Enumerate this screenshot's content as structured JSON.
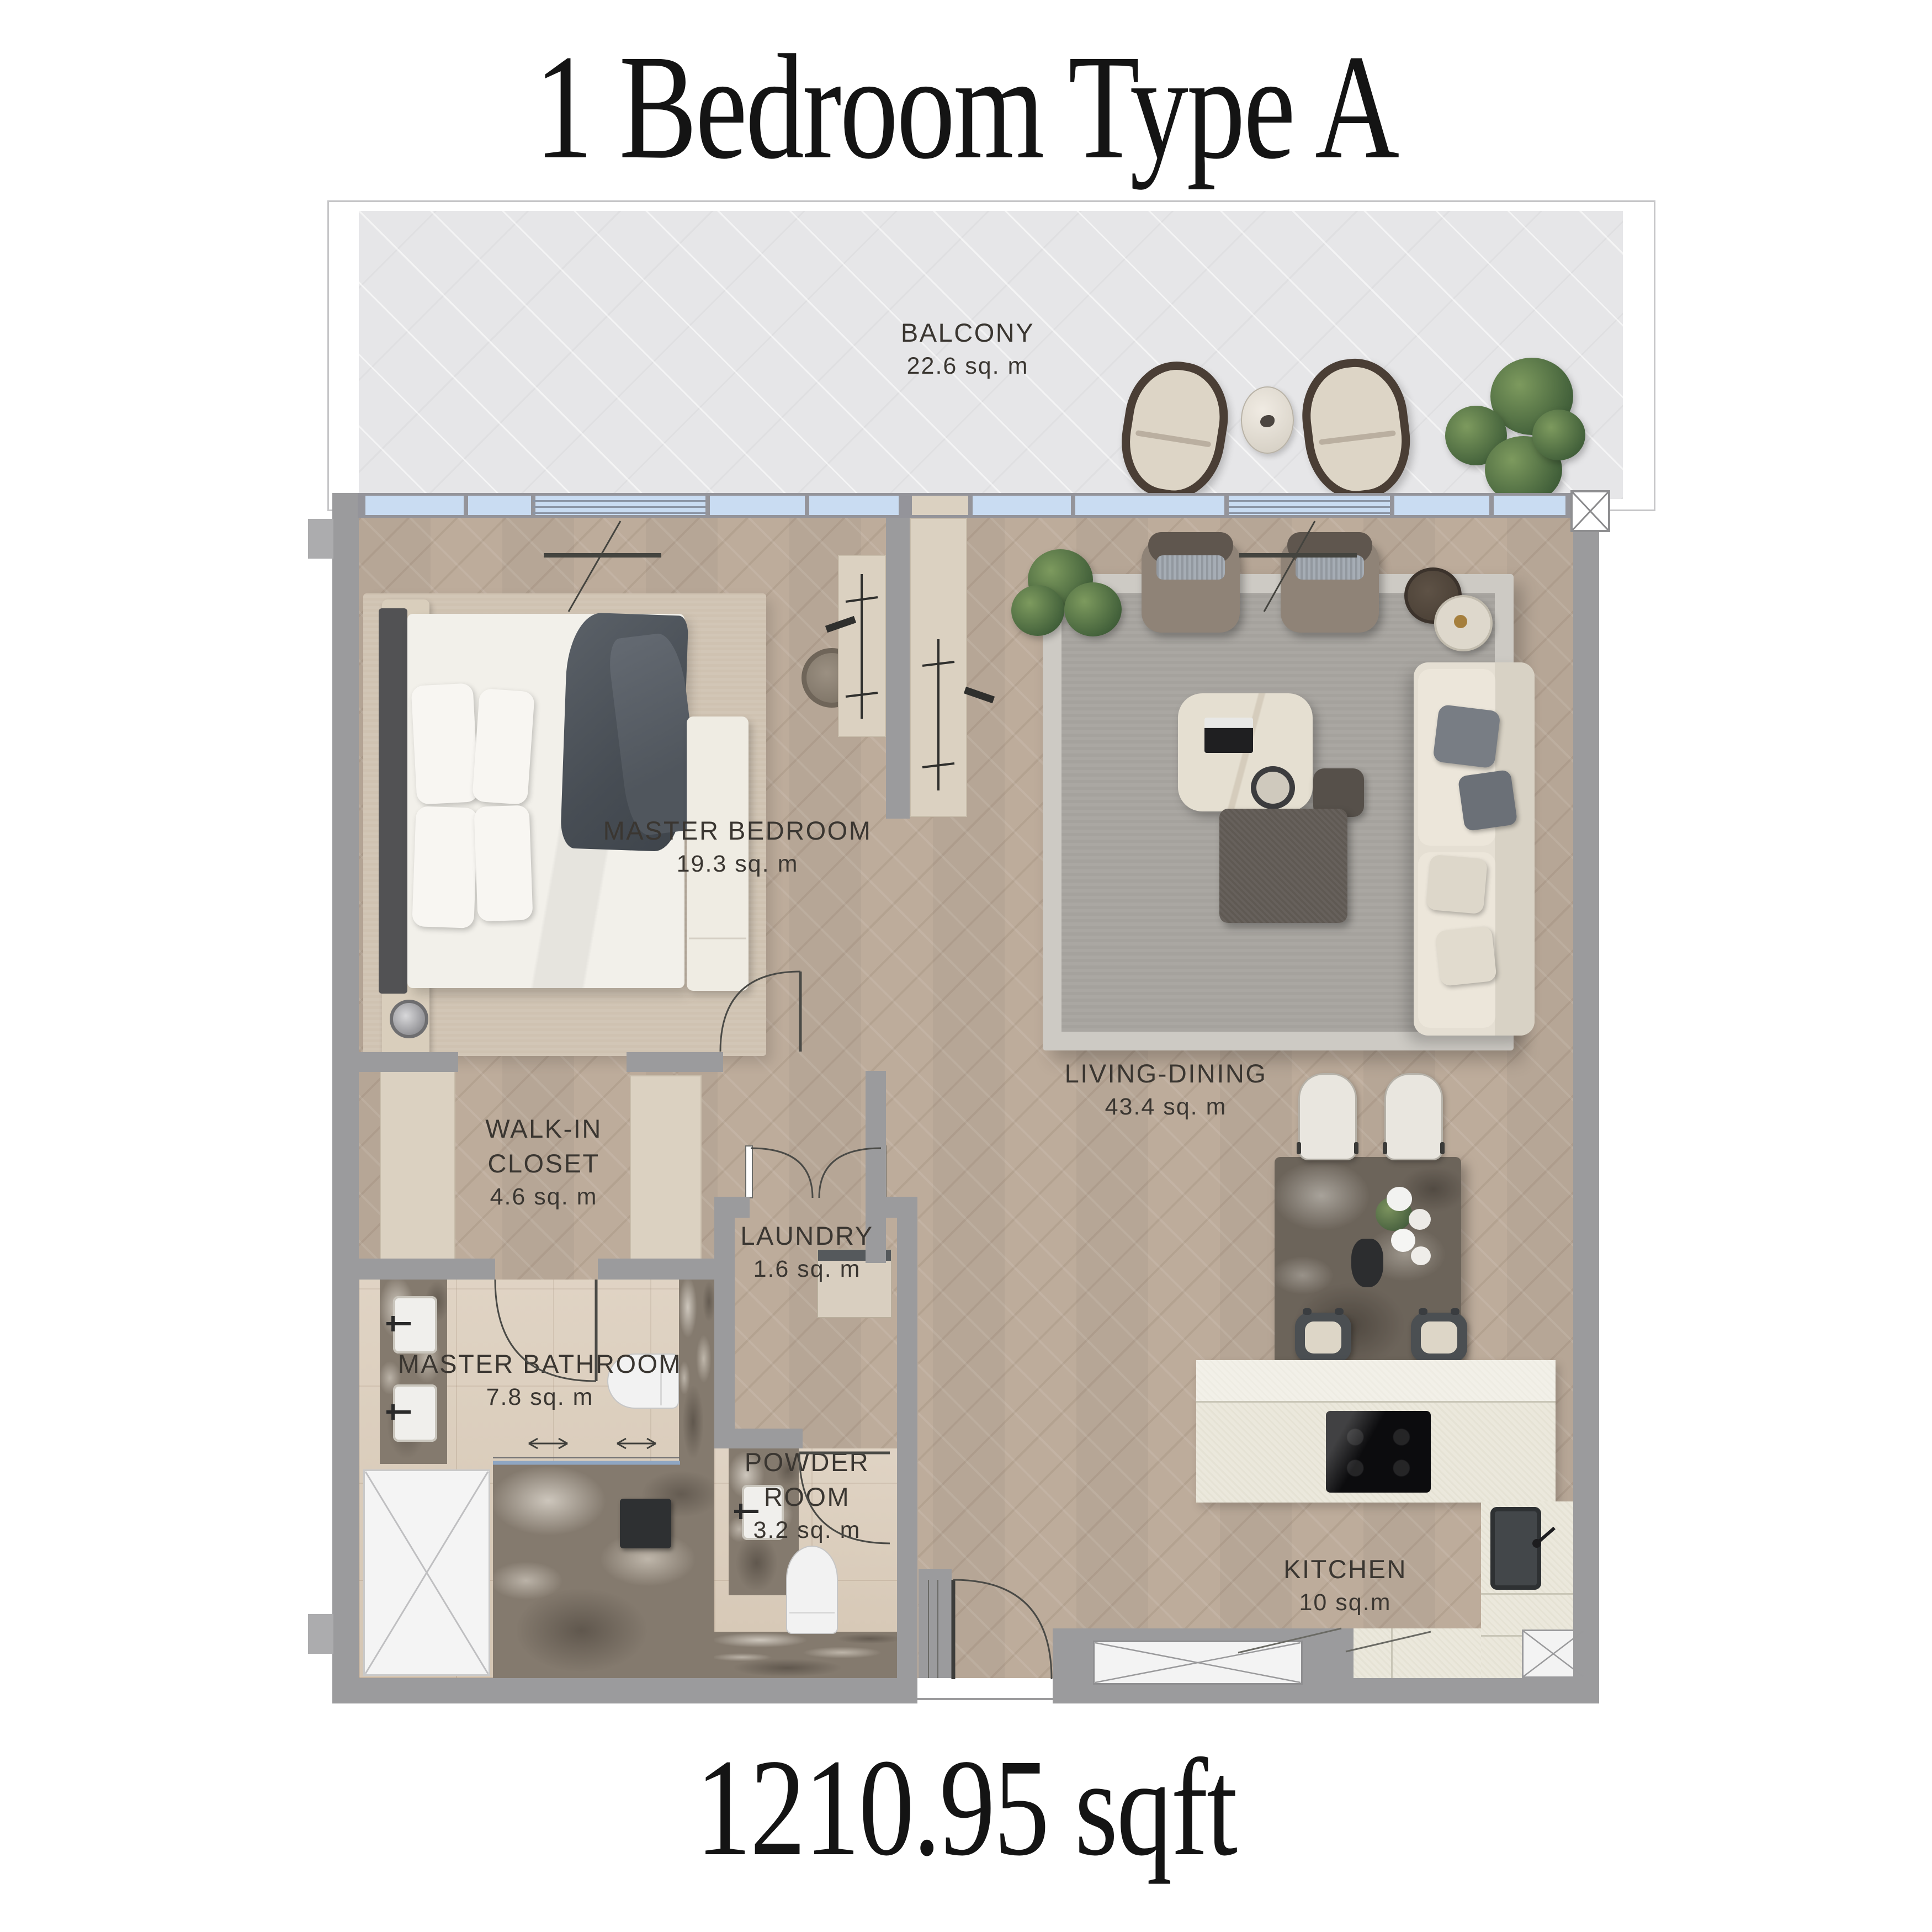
{
  "title": "1 Bedroom Type A",
  "total_area": "1210.95 sqft",
  "rooms": {
    "balcony": {
      "name": "BALCONY",
      "area": "22.6 sq. m"
    },
    "master_bedroom": {
      "name": "MASTER BEDROOM",
      "area": "19.3 sq. m"
    },
    "living_dining": {
      "name": "LIVING-DINING",
      "area": "43.4 sq. m"
    },
    "walk_in_closet": {
      "name1": "WALK-IN",
      "name2": "CLOSET",
      "area": "4.6 sq. m"
    },
    "laundry": {
      "name": "LAUNDRY",
      "area": "1.6 sq. m"
    },
    "master_bathroom": {
      "name": "MASTER BATHROOM",
      "area": "7.8 sq. m"
    },
    "powder_room": {
      "name1": "POWDER",
      "name2": "ROOM",
      "area": "3.2 sq. m"
    },
    "kitchen": {
      "name": "KITCHEN",
      "area": "10 sq.m"
    }
  },
  "colors": {
    "wall": "#9b9b9d",
    "wood_floor": "#bdac9b",
    "balcony_floor": "#e6e6e8",
    "glazing": "#c9dcf2",
    "closet_beige": "#dbd1c1",
    "counter_cream": "#ebe8dc",
    "label_text": "#3a3631"
  }
}
